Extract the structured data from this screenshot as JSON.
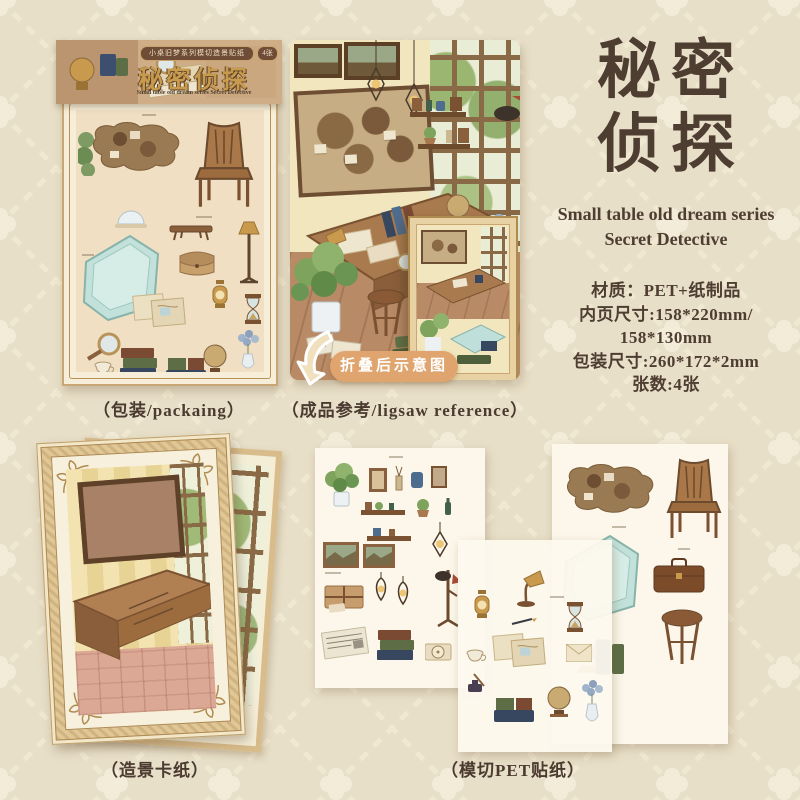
{
  "colors": {
    "background": "#e8dfc8",
    "text": "#4e3d31",
    "badge_accent": "#e0a46e",
    "package_gold": "#c89a4e"
  },
  "package": {
    "series_pill": "小桌旧梦系列模切造景贴纸",
    "count_badge": "4张",
    "title": "秘密侦探",
    "subtitle": "Small table old dream series Secret Detective",
    "caption": "（包装/packaing）"
  },
  "reference": {
    "caption": "（成品参考/ligsaw reference）",
    "fold_badge": "折叠后示意图"
  },
  "info": {
    "title_line1": "秘密",
    "title_line2": "侦探",
    "subtitle_line1": "Small table old dream series",
    "subtitle_line2": "Secret Detective",
    "specs": [
      "材质：PET+纸制品",
      "内页尺寸:158*220mm/",
      "158*130mm",
      "包装尺寸:260*172*2mm",
      "张数:4张"
    ]
  },
  "card": {
    "caption": "（造景卡纸）"
  },
  "stickers": {
    "caption": "（模切PET贴纸）"
  }
}
